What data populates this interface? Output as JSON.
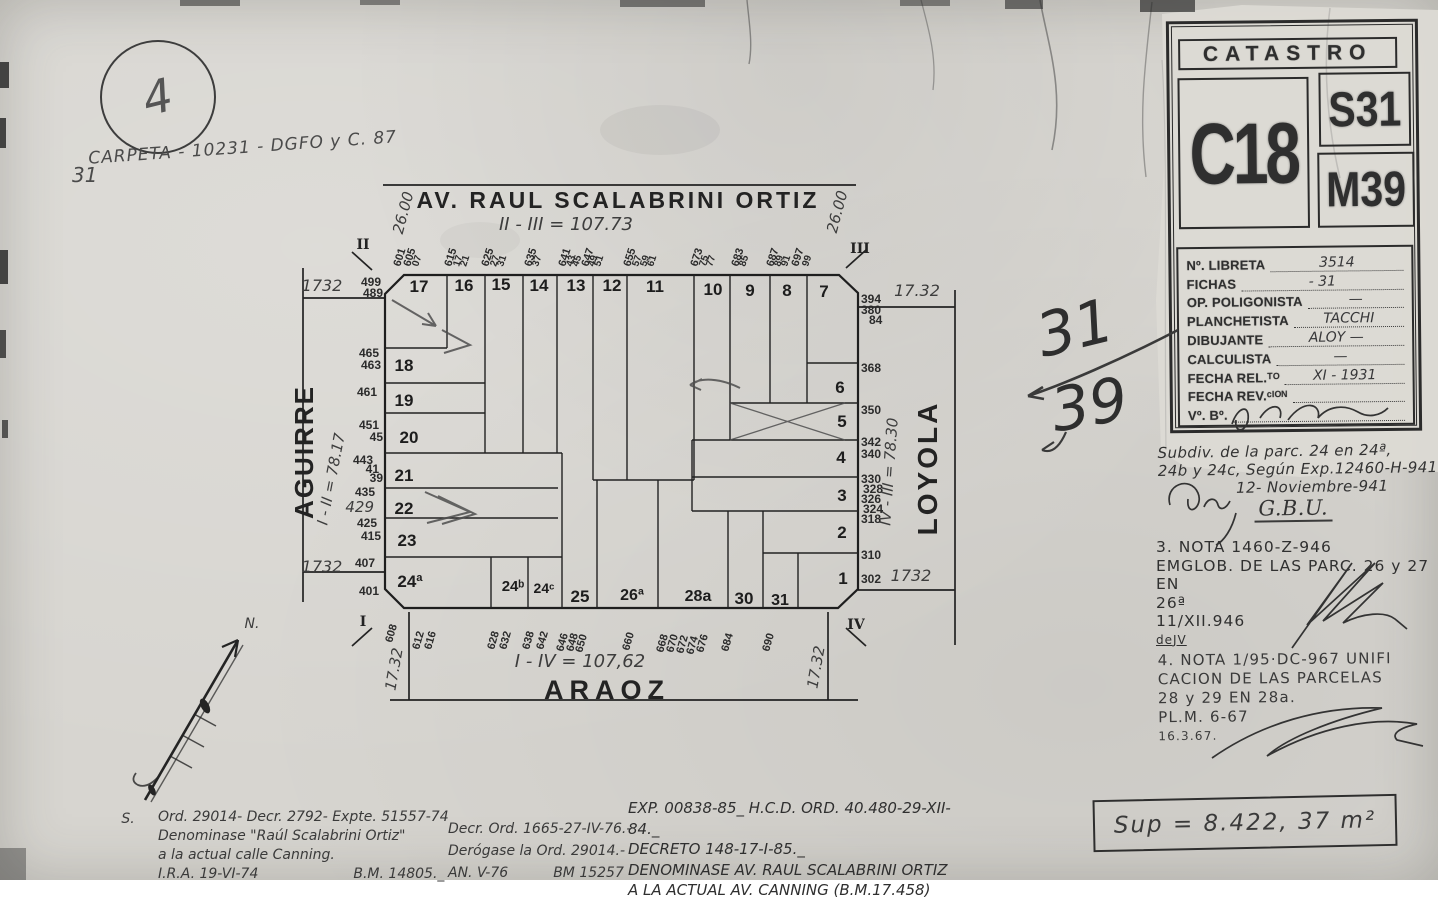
{
  "page": {
    "circle_number": "4",
    "carpeta_note": "CARPETA - 10231 - DGFO y C. 87",
    "carpeta_number": "31"
  },
  "stamp": {
    "title": "CATASTRO",
    "circunscripcion": "C18",
    "seccion": "S31",
    "manzana": "M39",
    "fields": [
      {
        "label": "Nº. LIBRETA",
        "value": "3514"
      },
      {
        "label": "FICHAS",
        "value": "-   31"
      },
      {
        "label": "OP. POLIGONISTA",
        "value": "—"
      },
      {
        "label": "PLANCHETISTA",
        "value": "TACCHI"
      },
      {
        "label": "DIBUJANTE",
        "value": "ALOY   —"
      },
      {
        "label": "CALCULISTA",
        "value": "—"
      },
      {
        "label": "FECHA REL.ᵀᴼ",
        "value": "XI - 1931"
      },
      {
        "label": "FECHA REV.ᶜᴵᴼᴺ",
        "value": ""
      },
      {
        "label": "Vº. Bº.",
        "value": ""
      }
    ]
  },
  "notes": {
    "subdiv": {
      "lines": [
        "Subdiv. de la parc. 24 en 24ª,",
        "24b y 24c, Según Exp.12460-H-941"
      ],
      "date": "12- Noviembre-941",
      "initials": "G.B.U."
    },
    "nota3": {
      "lines": [
        "3. NOTA 1460-Z-946",
        "EMGLOB. DE LAS PARC. 26 y 27 EN",
        "26ª",
        "11/XII.946",
        "deJV"
      ]
    },
    "nota4": {
      "lines": [
        "4. NOTA 1/95·DC-967 UNIFI",
        "CACION DE LAS PARCELAS",
        "28 y 29 EN 28a.",
        "PL.M. 6-67",
        "16.3.67."
      ]
    }
  },
  "ordinances": {
    "left": [
      "Ord. 29014- Decr. 2792- Expte. 51557-74",
      "Denominase \"Raúl Scalabrini Ortiz\"",
      "a la actual calle Canning.",
      "I.R.A. 19-VI-74",
      "B.M. 14805._"
    ],
    "center": [
      "Decr. Ord. 1665-27-IV-76.-",
      "Derógase la Ord. 29014.-",
      "AN. V-76",
      "BM 15257"
    ],
    "right": [
      "EXP. 00838-85_ H.C.D. ORD. 40.480-29-XII-84._",
      "DECRETO 148-17-I-85._",
      "DENOMINASE AV. RAUL SCALABRINI ORTIZ",
      "A LA ACTUAL AV. CANNING (B.M.17.458)"
    ]
  },
  "surface": "Sup = 8.422, 37   m²",
  "map": {
    "streets": {
      "top": "AV. RAUL SCALABRINI ORTIZ",
      "left": "AGUIRRE",
      "right": "LOYOLA",
      "bottom": "ARAOZ"
    },
    "labels": [
      {
        "t": "AV. RAUL SCALABRINI ORTIZ",
        "x": 618,
        "y": 208,
        "s": 23,
        "c": "street",
        "ls": 3
      },
      {
        "t": "ARAOZ",
        "x": 607,
        "y": 699,
        "s": 27,
        "c": "street",
        "ls": 6
      },
      {
        "t": "AGUIRRE",
        "x": 313,
        "y": 452,
        "s": 26,
        "c": "street",
        "r": -90,
        "ls": 2
      },
      {
        "t": "LOYOLA",
        "x": 937,
        "y": 468,
        "s": 28,
        "c": "street",
        "r": -90,
        "ls": 3
      },
      {
        "t": "II - III = 107.73",
        "x": 566,
        "y": 230,
        "s": 18,
        "c": "hand"
      },
      {
        "t": "I - IV = 107,62",
        "x": 580,
        "y": 667,
        "s": 18,
        "c": "hand"
      },
      {
        "t": "I - II = 78.17",
        "x": 336,
        "y": 480,
        "s": 15,
        "c": "hand",
        "r": -79
      },
      {
        "t": "IV - III = 78.30",
        "x": 894,
        "y": 472,
        "s": 15,
        "c": "hand",
        "r": -86
      },
      {
        "t": "26.00",
        "x": 408,
        "y": 214,
        "s": 15,
        "c": "hand",
        "r": -75
      },
      {
        "t": "26.00",
        "x": 842,
        "y": 213,
        "s": 15,
        "c": "hand",
        "r": -75
      },
      {
        "t": "1732",
        "x": 322,
        "y": 291,
        "s": 16,
        "c": "hand"
      },
      {
        "t": "17.32",
        "x": 917,
        "y": 296,
        "s": 16,
        "c": "hand"
      },
      {
        "t": "1732",
        "x": 322,
        "y": 572,
        "s": 16,
        "c": "hand"
      },
      {
        "t": "1732",
        "x": 911,
        "y": 581,
        "s": 16,
        "c": "hand"
      },
      {
        "t": "17.32",
        "x": 399,
        "y": 670,
        "s": 15,
        "c": "hand",
        "r": -80
      },
      {
        "t": "17.32",
        "x": 821,
        "y": 668,
        "s": 15,
        "c": "hand",
        "r": -80
      },
      {
        "t": "II",
        "x": 363,
        "y": 249,
        "s": 14,
        "c": "roman"
      },
      {
        "t": "III",
        "x": 860,
        "y": 253,
        "s": 14,
        "c": "roman"
      },
      {
        "t": "I",
        "x": 363,
        "y": 626,
        "s": 14,
        "c": "roman"
      },
      {
        "t": "IV",
        "x": 856,
        "y": 629,
        "s": 14,
        "c": "roman"
      },
      {
        "t": "N.",
        "x": 252,
        "y": 628,
        "s": 14,
        "c": "hand"
      },
      {
        "t": "S.",
        "x": 128,
        "y": 823,
        "s": 14,
        "c": "hand"
      },
      {
        "t": "31",
        "x": 1080,
        "y": 348,
        "s": 60,
        "c": "bighand",
        "r": -14
      },
      {
        "t": "39",
        "x": 1093,
        "y": 425,
        "s": 60,
        "c": "bighand",
        "r": -10
      },
      {
        "t": "17",
        "x": 419,
        "y": 292,
        "s": 17,
        "c": "lot"
      },
      {
        "t": "16",
        "x": 464,
        "y": 291,
        "s": 17,
        "c": "lot"
      },
      {
        "t": "15",
        "x": 501,
        "y": 290,
        "s": 17,
        "c": "lot"
      },
      {
        "t": "14",
        "x": 539,
        "y": 291,
        "s": 17,
        "c": "lot"
      },
      {
        "t": "13",
        "x": 576,
        "y": 291,
        "s": 17,
        "c": "lot"
      },
      {
        "t": "12",
        "x": 612,
        "y": 291,
        "s": 17,
        "c": "lot"
      },
      {
        "t": "11",
        "x": 655,
        "y": 292,
        "s": 17,
        "c": "lot"
      },
      {
        "t": "10",
        "x": 713,
        "y": 295,
        "s": 17,
        "c": "lot"
      },
      {
        "t": "9",
        "x": 750,
        "y": 296,
        "s": 17,
        "c": "lot"
      },
      {
        "t": "8",
        "x": 787,
        "y": 296,
        "s": 17,
        "c": "lot"
      },
      {
        "t": "7",
        "x": 824,
        "y": 297,
        "s": 17,
        "c": "lot"
      },
      {
        "t": "18",
        "x": 404,
        "y": 371,
        "s": 17,
        "c": "lot"
      },
      {
        "t": "19",
        "x": 404,
        "y": 406,
        "s": 17,
        "c": "lot"
      },
      {
        "t": "20",
        "x": 409,
        "y": 443,
        "s": 17,
        "c": "lot"
      },
      {
        "t": "21",
        "x": 404,
        "y": 481,
        "s": 17,
        "c": "lot"
      },
      {
        "t": "22",
        "x": 404,
        "y": 514,
        "s": 17,
        "c": "lot"
      },
      {
        "t": "23",
        "x": 407,
        "y": 546,
        "s": 17,
        "c": "lot"
      },
      {
        "t": "24ª",
        "x": 410,
        "y": 587,
        "s": 17,
        "c": "lot"
      },
      {
        "t": "24ᵇ",
        "x": 513,
        "y": 591,
        "s": 15,
        "c": "lot"
      },
      {
        "t": "24ᶜ",
        "x": 544,
        "y": 593,
        "s": 14,
        "c": "lot"
      },
      {
        "t": "25",
        "x": 580,
        "y": 602,
        "s": 17,
        "c": "lot"
      },
      {
        "t": "26ª",
        "x": 632,
        "y": 600,
        "s": 16,
        "c": "lot"
      },
      {
        "t": "28a",
        "x": 698,
        "y": 601,
        "s": 16,
        "c": "lot"
      },
      {
        "t": "30",
        "x": 744,
        "y": 604,
        "s": 17,
        "c": "lot"
      },
      {
        "t": "31",
        "x": 780,
        "y": 605,
        "s": 16,
        "c": "lot"
      },
      {
        "t": "6",
        "x": 840,
        "y": 393,
        "s": 17,
        "c": "lot"
      },
      {
        "t": "5",
        "x": 842,
        "y": 427,
        "s": 17,
        "c": "lot"
      },
      {
        "t": "4",
        "x": 841,
        "y": 463,
        "s": 17,
        "c": "lot"
      },
      {
        "t": "3",
        "x": 842,
        "y": 501,
        "s": 17,
        "c": "lot"
      },
      {
        "t": "2",
        "x": 842,
        "y": 538,
        "s": 17,
        "c": "lot"
      },
      {
        "t": "1",
        "x": 843,
        "y": 584,
        "s": 17,
        "c": "lot"
      },
      {
        "t": "601",
        "x": 400,
        "y": 267,
        "s": 11,
        "c": "addr",
        "r": -72,
        "a": "start"
      },
      {
        "t": "605",
        "x": 410,
        "y": 267,
        "s": 11,
        "c": "addr",
        "r": -72,
        "a": "start"
      },
      {
        "t": "07",
        "x": 418,
        "y": 267,
        "s": 10,
        "c": "addr",
        "r": -72,
        "a": "start"
      },
      {
        "t": "615",
        "x": 451,
        "y": 267,
        "s": 11,
        "c": "addr",
        "r": -72,
        "a": "start"
      },
      {
        "t": "17",
        "x": 459,
        "y": 267,
        "s": 10,
        "c": "addr",
        "r": -72,
        "a": "start"
      },
      {
        "t": "21",
        "x": 466,
        "y": 267,
        "s": 10,
        "c": "addr",
        "r": -72,
        "a": "start"
      },
      {
        "t": "625",
        "x": 488,
        "y": 267,
        "s": 11,
        "c": "addr",
        "r": -72,
        "a": "start"
      },
      {
        "t": "27",
        "x": 496,
        "y": 267,
        "s": 10,
        "c": "addr",
        "r": -72,
        "a": "start"
      },
      {
        "t": "31",
        "x": 503,
        "y": 267,
        "s": 10,
        "c": "addr",
        "r": -72,
        "a": "start"
      },
      {
        "t": "635",
        "x": 531,
        "y": 267,
        "s": 11,
        "c": "addr",
        "r": -72,
        "a": "start"
      },
      {
        "t": "37",
        "x": 538,
        "y": 267,
        "s": 10,
        "c": "addr",
        "r": -72,
        "a": "start"
      },
      {
        "t": "641",
        "x": 565,
        "y": 267,
        "s": 11,
        "c": "addr",
        "r": -72,
        "a": "start"
      },
      {
        "t": "43",
        "x": 572,
        "y": 267,
        "s": 10,
        "c": "addr",
        "r": -72,
        "a": "start"
      },
      {
        "t": "45",
        "x": 578,
        "y": 267,
        "s": 10,
        "c": "addr",
        "r": -72,
        "a": "start"
      },
      {
        "t": "647",
        "x": 588,
        "y": 267,
        "s": 11,
        "c": "addr",
        "r": -72,
        "a": "start"
      },
      {
        "t": "49",
        "x": 594,
        "y": 267,
        "s": 10,
        "c": "addr",
        "r": -72,
        "a": "start"
      },
      {
        "t": "51",
        "x": 600,
        "y": 267,
        "s": 10,
        "c": "addr",
        "r": -72,
        "a": "start"
      },
      {
        "t": "655",
        "x": 630,
        "y": 267,
        "s": 11,
        "c": "addr",
        "r": -72,
        "a": "start"
      },
      {
        "t": "57",
        "x": 638,
        "y": 267,
        "s": 10,
        "c": "addr",
        "r": -72,
        "a": "start"
      },
      {
        "t": "59",
        "x": 646,
        "y": 267,
        "s": 10,
        "c": "addr",
        "r": -72,
        "a": "start"
      },
      {
        "t": "61",
        "x": 653,
        "y": 267,
        "s": 10,
        "c": "addr",
        "r": -72,
        "a": "start"
      },
      {
        "t": "673",
        "x": 697,
        "y": 267,
        "s": 11,
        "c": "addr",
        "r": -72,
        "a": "start"
      },
      {
        "t": "75",
        "x": 705,
        "y": 267,
        "s": 10,
        "c": "addr",
        "r": -72,
        "a": "start"
      },
      {
        "t": "77",
        "x": 712,
        "y": 267,
        "s": 10,
        "c": "addr",
        "r": -72,
        "a": "start"
      },
      {
        "t": "683",
        "x": 738,
        "y": 267,
        "s": 11,
        "c": "addr",
        "r": -72,
        "a": "start"
      },
      {
        "t": "85",
        "x": 745,
        "y": 267,
        "s": 10,
        "c": "addr",
        "r": -72,
        "a": "start"
      },
      {
        "t": "687",
        "x": 773,
        "y": 267,
        "s": 11,
        "c": "addr",
        "r": -72,
        "a": "start"
      },
      {
        "t": "89",
        "x": 780,
        "y": 267,
        "s": 10,
        "c": "addr",
        "r": -72,
        "a": "start"
      },
      {
        "t": "91",
        "x": 787,
        "y": 267,
        "s": 10,
        "c": "addr",
        "r": -72,
        "a": "start"
      },
      {
        "t": "697",
        "x": 798,
        "y": 267,
        "s": 11,
        "c": "addr",
        "r": -72,
        "a": "start"
      },
      {
        "t": "99",
        "x": 808,
        "y": 267,
        "s": 10,
        "c": "addr",
        "r": -72,
        "a": "start"
      },
      {
        "t": "499",
        "x": 381,
        "y": 286,
        "s": 12,
        "c": "addr",
        "a": "end"
      },
      {
        "t": "489",
        "x": 383,
        "y": 297,
        "s": 12,
        "c": "addr",
        "a": "end"
      },
      {
        "t": "465",
        "x": 379,
        "y": 357,
        "s": 12,
        "c": "addr",
        "a": "end"
      },
      {
        "t": "463",
        "x": 381,
        "y": 369,
        "s": 12,
        "c": "addr",
        "a": "end"
      },
      {
        "t": "461",
        "x": 377,
        "y": 396,
        "s": 12,
        "c": "addr",
        "a": "end"
      },
      {
        "t": "451",
        "x": 379,
        "y": 429,
        "s": 12,
        "c": "addr",
        "a": "end"
      },
      {
        "t": "45",
        "x": 383,
        "y": 441,
        "s": 12,
        "c": "addr",
        "a": "end"
      },
      {
        "t": "443",
        "x": 373,
        "y": 464,
        "s": 12,
        "c": "addr",
        "a": "end"
      },
      {
        "t": "41",
        "x": 379,
        "y": 473,
        "s": 12,
        "c": "addr",
        "a": "end"
      },
      {
        "t": "39",
        "x": 383,
        "y": 482,
        "s": 12,
        "c": "addr",
        "a": "end"
      },
      {
        "t": "435",
        "x": 375,
        "y": 496,
        "s": 12,
        "c": "addr",
        "a": "end"
      },
      {
        "t": "429",
        "x": 374,
        "y": 512,
        "s": 15,
        "c": "hand",
        "a": "end"
      },
      {
        "t": "425",
        "x": 377,
        "y": 527,
        "s": 12,
        "c": "addr",
        "a": "end"
      },
      {
        "t": "415",
        "x": 381,
        "y": 540,
        "s": 12,
        "c": "addr",
        "a": "end"
      },
      {
        "t": "407",
        "x": 375,
        "y": 567,
        "s": 12,
        "c": "addr",
        "a": "end"
      },
      {
        "t": "401",
        "x": 379,
        "y": 595,
        "s": 12,
        "c": "addr",
        "a": "end"
      },
      {
        "t": "394",
        "x": 861,
        "y": 303,
        "s": 12,
        "c": "addr",
        "a": "start"
      },
      {
        "t": "380",
        "x": 861,
        "y": 314,
        "s": 12,
        "c": "addr",
        "a": "start"
      },
      {
        "t": "84",
        "x": 869,
        "y": 324,
        "s": 12,
        "c": "addr",
        "a": "start"
      },
      {
        "t": "368",
        "x": 861,
        "y": 372,
        "s": 12,
        "c": "addr",
        "a": "start"
      },
      {
        "t": "350",
        "x": 861,
        "y": 414,
        "s": 12,
        "c": "addr",
        "a": "start"
      },
      {
        "t": "342",
        "x": 861,
        "y": 446,
        "s": 12,
        "c": "addr",
        "a": "start"
      },
      {
        "t": "340",
        "x": 861,
        "y": 458,
        "s": 12,
        "c": "addr",
        "a": "start"
      },
      {
        "t": "330",
        "x": 861,
        "y": 483,
        "s": 12,
        "c": "addr",
        "a": "start"
      },
      {
        "t": "328",
        "x": 863,
        "y": 493,
        "s": 12,
        "c": "addr",
        "a": "start"
      },
      {
        "t": "326",
        "x": 861,
        "y": 503,
        "s": 12,
        "c": "addr",
        "a": "start"
      },
      {
        "t": "324",
        "x": 863,
        "y": 513,
        "s": 12,
        "c": "addr",
        "a": "start"
      },
      {
        "t": "318",
        "x": 861,
        "y": 523,
        "s": 12,
        "c": "addr",
        "a": "start"
      },
      {
        "t": "310",
        "x": 861,
        "y": 559,
        "s": 12,
        "c": "addr",
        "a": "start"
      },
      {
        "t": "302",
        "x": 861,
        "y": 583,
        "s": 12,
        "c": "addr",
        "a": "start"
      },
      {
        "t": "608",
        "x": 392,
        "y": 643,
        "s": 11,
        "c": "addr",
        "r": -74,
        "a": "start"
      },
      {
        "t": "612",
        "x": 419,
        "y": 650,
        "s": 11,
        "c": "addr",
        "r": -74,
        "a": "start"
      },
      {
        "t": "616",
        "x": 431,
        "y": 650,
        "s": 11,
        "c": "addr",
        "r": -74,
        "a": "start"
      },
      {
        "t": "628",
        "x": 494,
        "y": 650,
        "s": 11,
        "c": "addr",
        "r": -74,
        "a": "start"
      },
      {
        "t": "632",
        "x": 506,
        "y": 650,
        "s": 11,
        "c": "addr",
        "r": -74,
        "a": "start"
      },
      {
        "t": "638",
        "x": 529,
        "y": 650,
        "s": 11,
        "c": "addr",
        "r": -74,
        "a": "start"
      },
      {
        "t": "642",
        "x": 543,
        "y": 650,
        "s": 11,
        "c": "addr",
        "r": -74,
        "a": "start"
      },
      {
        "t": "646",
        "x": 563,
        "y": 652,
        "s": 11,
        "c": "addr",
        "r": -74,
        "a": "start"
      },
      {
        "t": "648",
        "x": 573,
        "y": 652,
        "s": 11,
        "c": "addr",
        "r": -74,
        "a": "start"
      },
      {
        "t": "650",
        "x": 582,
        "y": 653,
        "s": 11,
        "c": "addr",
        "r": -74,
        "a": "start"
      },
      {
        "t": "660",
        "x": 629,
        "y": 651,
        "s": 11,
        "c": "addr",
        "r": -74,
        "a": "start"
      },
      {
        "t": "668",
        "x": 663,
        "y": 653,
        "s": 11,
        "c": "addr",
        "r": -74,
        "a": "start"
      },
      {
        "t": "670",
        "x": 673,
        "y": 653,
        "s": 11,
        "c": "addr",
        "r": -74,
        "a": "start"
      },
      {
        "t": "672",
        "x": 683,
        "y": 654,
        "s": 11,
        "c": "addr",
        "r": -74,
        "a": "start"
      },
      {
        "t": "674",
        "x": 693,
        "y": 655,
        "s": 11,
        "c": "addr",
        "r": -74,
        "a": "start"
      },
      {
        "t": "676",
        "x": 703,
        "y": 653,
        "s": 11,
        "c": "addr",
        "r": -74,
        "a": "start"
      },
      {
        "t": "684",
        "x": 728,
        "y": 652,
        "s": 11,
        "c": "addr",
        "r": -74,
        "a": "start"
      },
      {
        "t": "690",
        "x": 769,
        "y": 652,
        "s": 11,
        "c": "addr",
        "r": -74,
        "a": "start"
      }
    ]
  }
}
